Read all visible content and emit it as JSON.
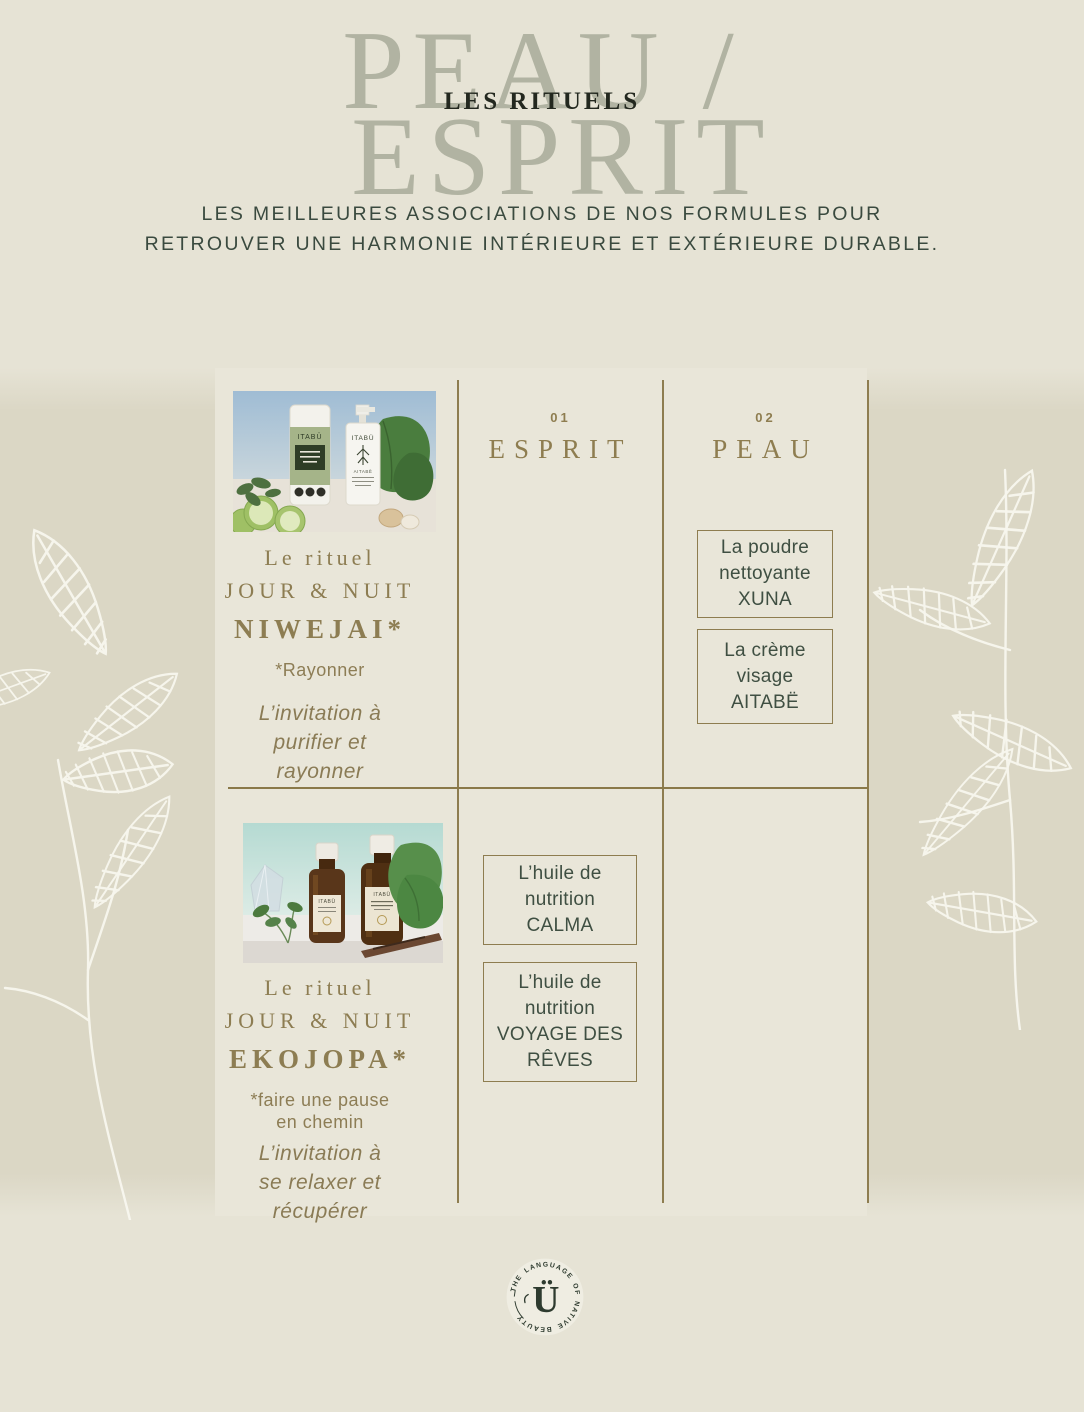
{
  "theme": {
    "background": "#e6e3d5",
    "side_band": "#dbd7c5",
    "center_panel": "#e9e6d9",
    "title_gray_green": "#b1b3a2",
    "dark_green": "#3a4a3f",
    "olive_accent": "#8e7d50",
    "box_text_green": "#3f4f42",
    "logo_green": "#2e3b2f",
    "leaf_sketch_white": "#f8f7ef"
  },
  "header": {
    "title_line1": "PEAU /",
    "title_line2": "ESPRIT",
    "overlay": "LES RITUELS",
    "subtitle_lines": [
      "LES MEILLEURES ASSOCIATIONS DE NOS FORMULES POUR",
      "RETROUVER UNE HARMONIE INTÉRIEURE ET EXTÉRIEURE DURABLE."
    ]
  },
  "columns": [
    {
      "number": "01",
      "label": "ESPRIT"
    },
    {
      "number": "02",
      "label": "PEAU"
    }
  ],
  "rituals": [
    {
      "intro": "Le rituel",
      "variant": "JOUR & NUIT",
      "name": "NIWEJAI*",
      "meaning_lines": [
        "*Rayonner"
      ],
      "invitation_lines": [
        "L’invitation à",
        "purifier et",
        "rayonner"
      ],
      "photo_brand": "ITABÜ",
      "photo_secondary": "AITABË",
      "esprit_products": [],
      "peau_products": [
        "La poudre nettoyante XUNA",
        "La crème visage AITABË"
      ]
    },
    {
      "intro": "Le rituel",
      "variant": "JOUR & NUIT",
      "name": "EKOJOPA*",
      "meaning_lines": [
        "*faire une pause",
        "en chemin"
      ],
      "invitation_lines": [
        "L’invitation à",
        "se relaxer et",
        "récupérer"
      ],
      "photo_brand": "ITABÜ",
      "esprit_products": [
        "L’huile de nutrition CALMA",
        "L’huile de nutrition VOYAGE DES RÊVES"
      ],
      "peau_products": []
    }
  ],
  "logo": {
    "circular_text": "THE LANGUAGE OF NATIVE BEAUTY",
    "mark": "Ü"
  }
}
